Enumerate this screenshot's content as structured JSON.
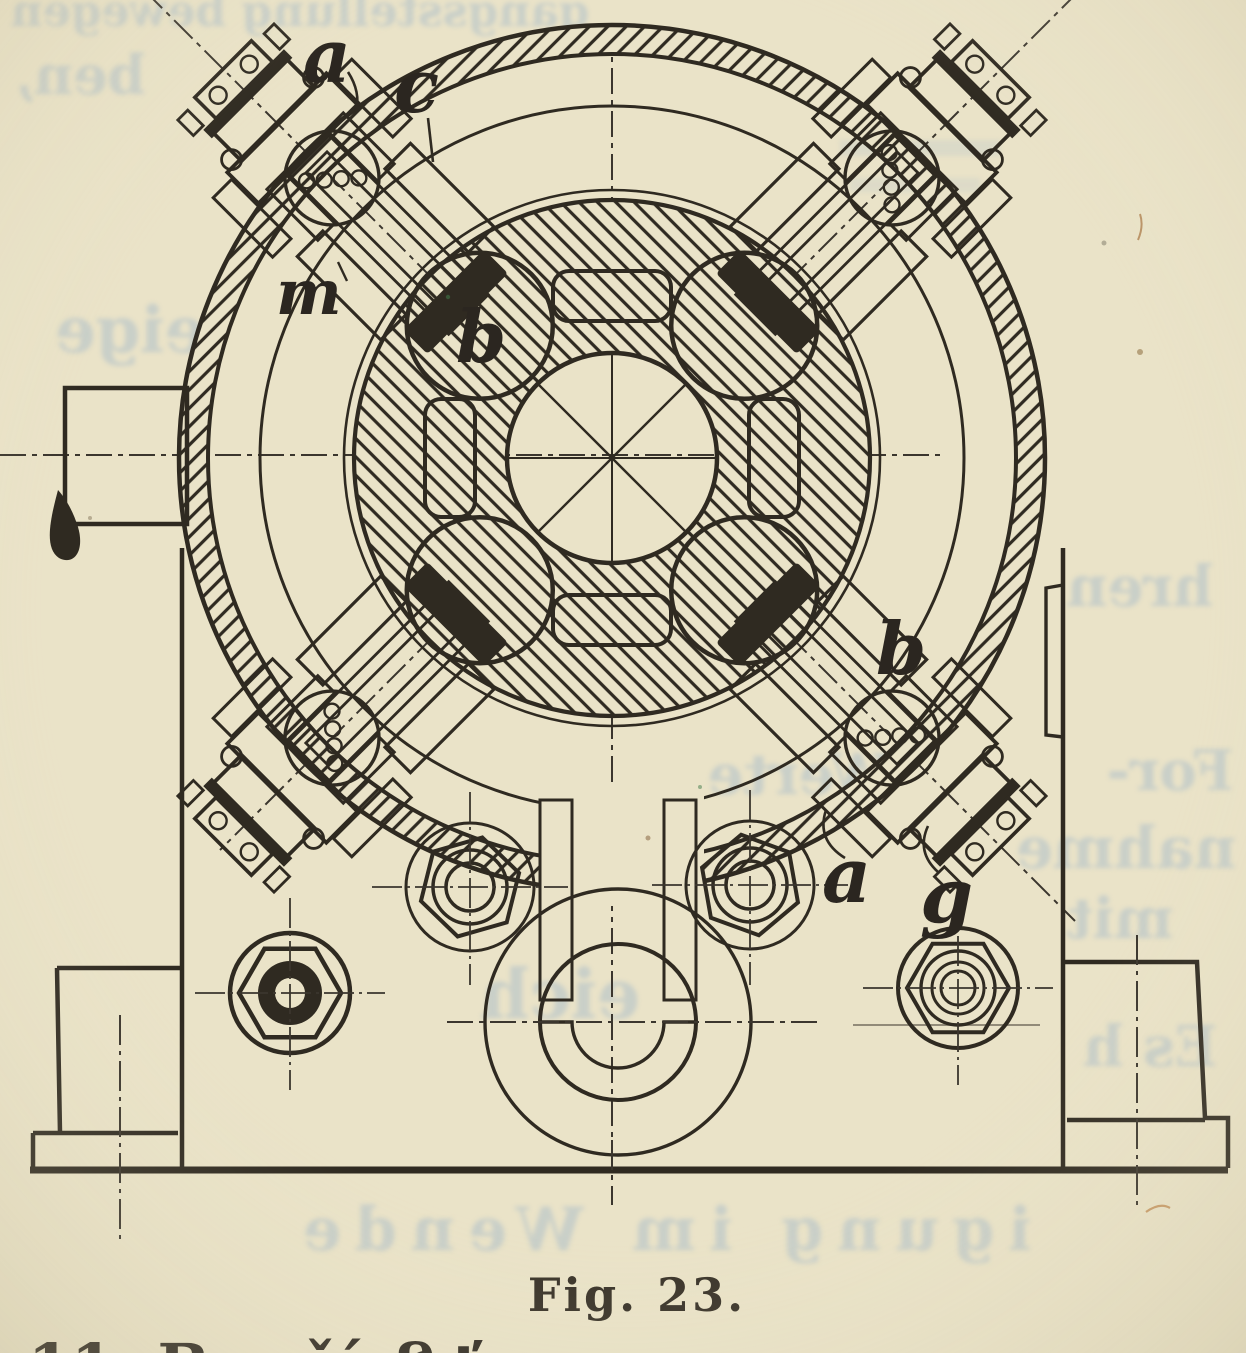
{
  "figure_caption": "Fig. 23.",
  "part_labels": [
    {
      "id": "a-top-left",
      "text": "a"
    },
    {
      "id": "c-top-left",
      "text": "c"
    },
    {
      "id": "m-upper-left",
      "text": "m"
    },
    {
      "id": "b-upper",
      "text": "b"
    },
    {
      "id": "b-right",
      "text": "b"
    },
    {
      "id": "a-bottom",
      "text": "a"
    },
    {
      "id": "g-bottom",
      "text": "g"
    }
  ],
  "bottom_text_fragments": [
    "11. B",
    "čí",
    "ß",
    "ť"
  ],
  "ghost_text_lines": [
    {
      "text": "gangsstellung bewegen",
      "x": 300,
      "y": 26,
      "size": 44
    },
    {
      "text": "ben,",
      "x": 80,
      "y": 94,
      "size": 54
    },
    {
      "text": "eige",
      "x": 130,
      "y": 352,
      "size": 64
    },
    {
      "text": "in die",
      "x": 735,
      "y": 606,
      "size": 56
    },
    {
      "text": "hren",
      "x": 1140,
      "y": 606,
      "size": 56
    },
    {
      "text": "sein",
      "x": 690,
      "y": 670,
      "size": 56
    },
    {
      "text": "Werte",
      "x": 800,
      "y": 794,
      "size": 56
    },
    {
      "text": "For-",
      "x": 1170,
      "y": 790,
      "size": 56
    },
    {
      "text": "nahme",
      "x": 1126,
      "y": 868,
      "size": 58
    },
    {
      "text": "mit",
      "x": 1120,
      "y": 938,
      "size": 56
    },
    {
      "text": "eich",
      "x": 560,
      "y": 1018,
      "size": 68
    },
    {
      "text": "Es h",
      "x": 1150,
      "y": 1066,
      "size": 56
    },
    {
      "text": "igung im Wende",
      "x": 660,
      "y": 1250,
      "size": 60
    }
  ],
  "colors": {
    "paper": "#eae3c8",
    "ink": "#2f2a21",
    "ghost_showthrough": "#a9bcc9",
    "caption": "#3a342a"
  }
}
